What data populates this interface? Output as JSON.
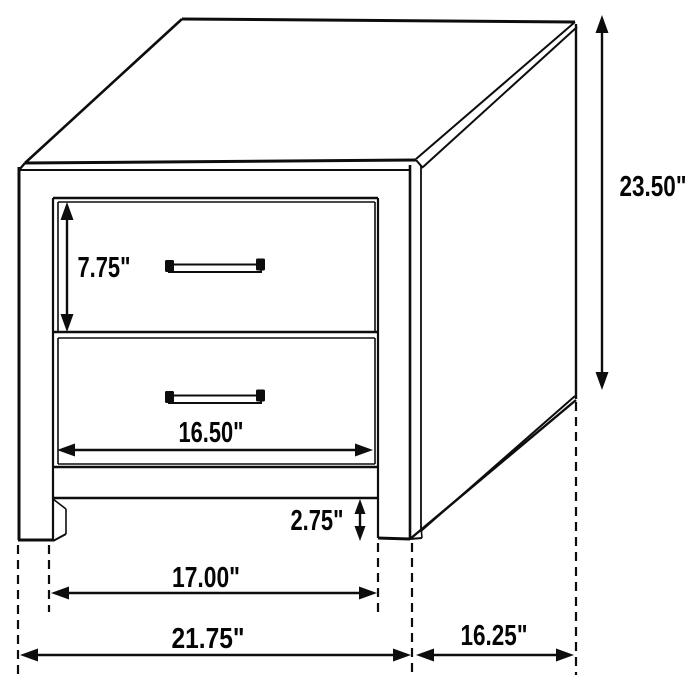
{
  "diagram": {
    "subject": "two-drawer nightstand dimension drawing",
    "background_color": "#ffffff",
    "line_color": "#0d0d0d",
    "dimensions": {
      "overall_height": "23.50\"",
      "top_drawer_front_height": "7.75\"",
      "drawer_front_width": "16.50\"",
      "leg_clearance_height": "2.75\"",
      "width_between_legs": "17.00\"",
      "overall_width": "21.75\"",
      "side_depth": "16.25\""
    }
  }
}
